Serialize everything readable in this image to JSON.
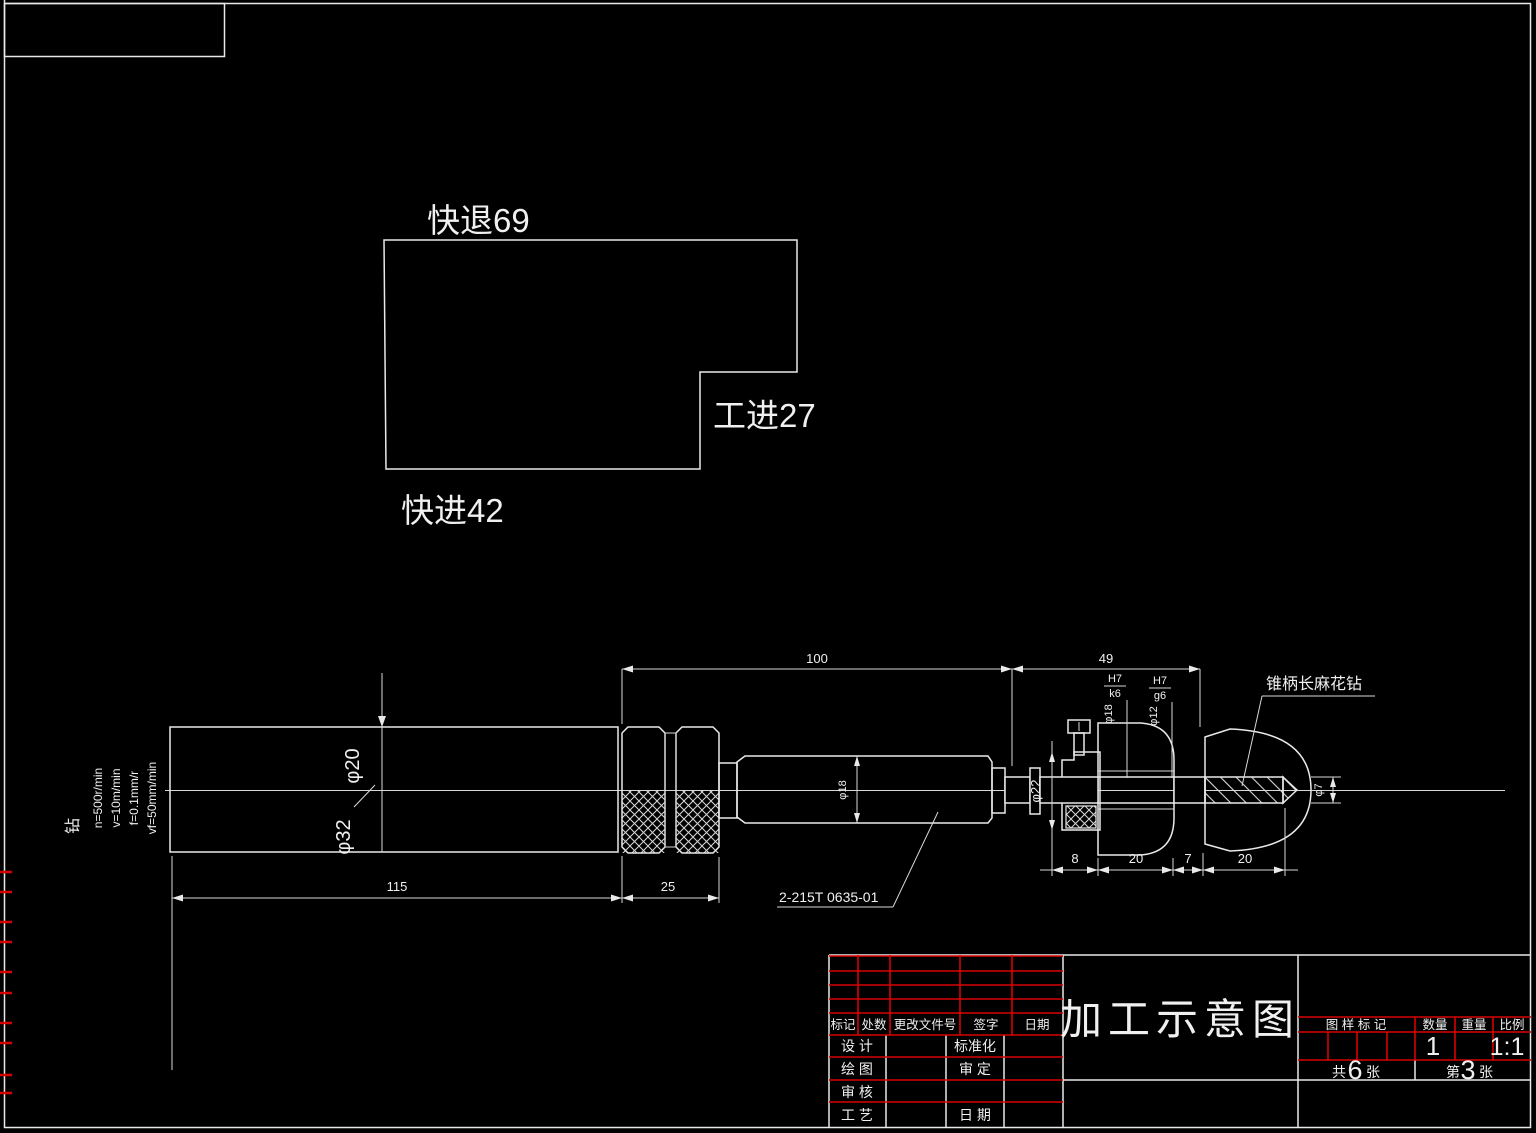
{
  "cycle": {
    "rapid_retract": "快退69",
    "work_feed": "工进27",
    "rapid_advance": "快进42"
  },
  "cutting_params": {
    "tool": "钻",
    "speed": "n=500r/min",
    "velocity": "v=10m/min",
    "feed": "f=0.1mm/r",
    "feed_rate": "vf=50mm/min"
  },
  "dimensions": {
    "len100": "100",
    "len49": "49",
    "len115": "115",
    "len25": "25",
    "len8": "8",
    "len20a": "20",
    "len7": "7",
    "len20b": "20",
    "dia20": "φ20",
    "dia32": "φ32",
    "dia18_sleeve": "φ18",
    "dia22": "φ22",
    "dia7": "φ7",
    "fit1_num": "H7",
    "fit1_den": "k6",
    "fit1_dia": "φ18",
    "fit2_num": "H7",
    "fit2_den": "g6",
    "fit2_dia": "φ12"
  },
  "labels": {
    "sleeve_part_no": "2-215T 0635-01",
    "drill_name": "锥柄长麻花钻"
  },
  "title_block": {
    "drawing_title": "加工示意图",
    "revision_headers": [
      "标记",
      "处数",
      "更改文件号",
      "签字",
      "日期"
    ],
    "sign_rows": [
      "设 计",
      "绘 图",
      "审 核",
      "工 艺"
    ],
    "approve_rows": [
      "标准化",
      "审 定",
      "日 期"
    ],
    "stamp": {
      "mark_header": "图 样 标 记",
      "qty_header": "数量",
      "weight_header": "重量",
      "scale_header": "比例",
      "qty": "1",
      "scale": "1:1"
    },
    "sheets": {
      "total_prefix": "共",
      "total": "6",
      "total_suffix": "张",
      "page_prefix": "第",
      "page": "3",
      "page_suffix": "张"
    }
  }
}
